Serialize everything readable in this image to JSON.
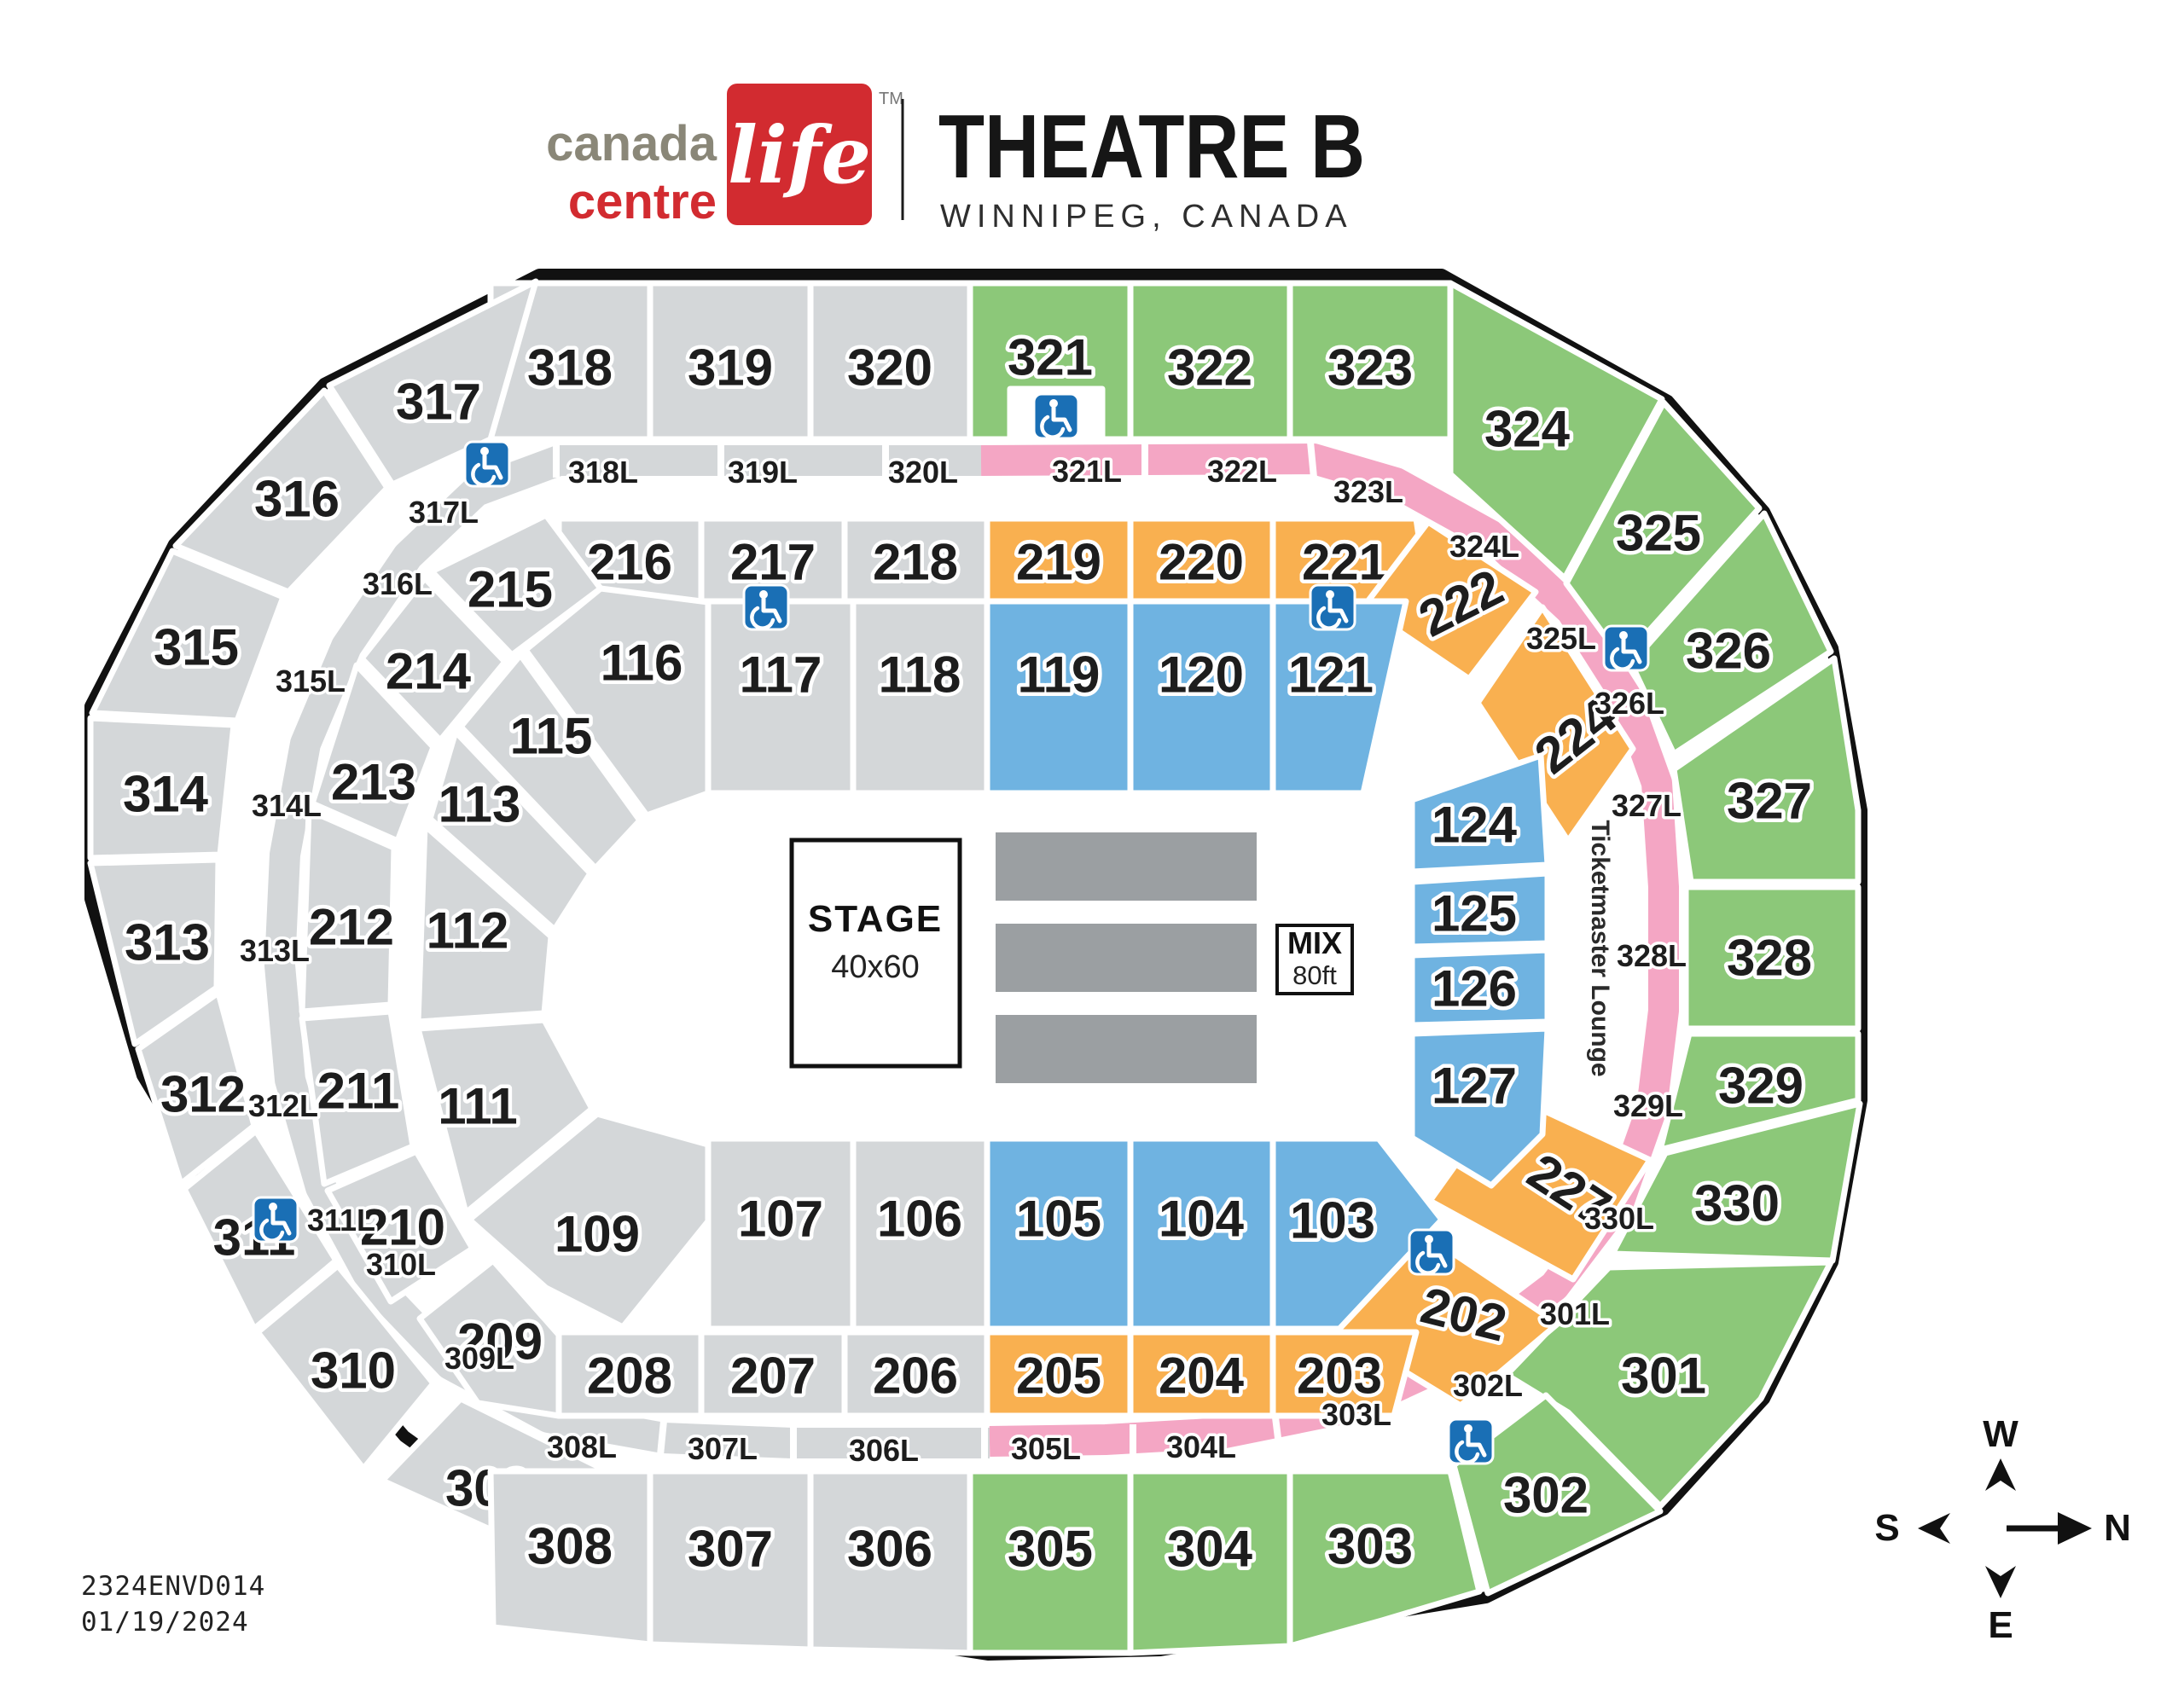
{
  "header": {
    "brand": {
      "word1": "canada",
      "word2": "life",
      "word3": "centre",
      "tm": "TM"
    },
    "title": "THEATRE B",
    "subtitle": "WINNIPEG, CANADA"
  },
  "footer": {
    "code": "2324ENVD014",
    "date": "01/19/2024"
  },
  "compass": {
    "up": "W",
    "right": "N",
    "left": "S",
    "down": "E"
  },
  "stage": {
    "line1": "STAGE",
    "line2": "40x60"
  },
  "mix": {
    "line1": "MIX",
    "line2": "80ft"
  },
  "lounge": {
    "label": "Ticketmaster Lounge"
  },
  "accessibility": {
    "icon": "wheelchair-icon",
    "count": 8
  },
  "colors": {
    "green": "#8CC879",
    "orange": "#F9B050",
    "blue": "#6FB3E1",
    "pink": "#F4A6C4",
    "gray": "#D4D7D9",
    "floor_block": "#9B9FA2",
    "outline": "#111111",
    "wheelchair": "#1A6FB5",
    "brand_red": "#D22B30",
    "brand_gray": "#8A8778"
  },
  "sections": [
    {
      "id": "318",
      "label": "318",
      "color": "gray"
    },
    {
      "id": "319",
      "label": "319",
      "color": "gray"
    },
    {
      "id": "320",
      "label": "320",
      "color": "gray"
    },
    {
      "id": "321",
      "label": "321",
      "color": "green"
    },
    {
      "id": "322",
      "label": "322",
      "color": "green"
    },
    {
      "id": "323",
      "label": "323",
      "color": "green"
    },
    {
      "id": "317",
      "label": "317",
      "color": "gray"
    },
    {
      "id": "324",
      "label": "324",
      "color": "green"
    },
    {
      "id": "316",
      "label": "316",
      "color": "gray"
    },
    {
      "id": "325",
      "label": "325",
      "color": "green"
    },
    {
      "id": "315",
      "label": "315",
      "color": "gray"
    },
    {
      "id": "326",
      "label": "326",
      "color": "green"
    },
    {
      "id": "314",
      "label": "314",
      "color": "gray"
    },
    {
      "id": "327",
      "label": "327",
      "color": "green"
    },
    {
      "id": "313",
      "label": "313",
      "color": "gray"
    },
    {
      "id": "328",
      "label": "328",
      "color": "green"
    },
    {
      "id": "312",
      "label": "312",
      "color": "gray"
    },
    {
      "id": "329",
      "label": "329",
      "color": "green"
    },
    {
      "id": "311",
      "label": "311",
      "color": "gray"
    },
    {
      "id": "330",
      "label": "330",
      "color": "green"
    },
    {
      "id": "310",
      "label": "310",
      "color": "gray"
    },
    {
      "id": "301",
      "label": "301",
      "color": "green"
    },
    {
      "id": "309",
      "label": "309",
      "color": "gray"
    },
    {
      "id": "302",
      "label": "302",
      "color": "green"
    },
    {
      "id": "308",
      "label": "308",
      "color": "gray"
    },
    {
      "id": "307",
      "label": "307",
      "color": "gray"
    },
    {
      "id": "306",
      "label": "306",
      "color": "gray"
    },
    {
      "id": "305",
      "label": "305",
      "color": "green"
    },
    {
      "id": "304",
      "label": "304",
      "color": "green"
    },
    {
      "id": "303",
      "label": "303",
      "color": "green"
    },
    {
      "id": "216",
      "label": "216",
      "color": "gray"
    },
    {
      "id": "217",
      "label": "217",
      "color": "gray"
    },
    {
      "id": "218",
      "label": "218",
      "color": "gray"
    },
    {
      "id": "219",
      "label": "219",
      "color": "orange"
    },
    {
      "id": "220",
      "label": "220",
      "color": "orange"
    },
    {
      "id": "221",
      "label": "221",
      "color": "orange"
    },
    {
      "id": "215",
      "label": "215",
      "color": "gray"
    },
    {
      "id": "222",
      "label": "222",
      "color": "orange"
    },
    {
      "id": "214",
      "label": "214",
      "color": "gray"
    },
    {
      "id": "224",
      "label": "224",
      "color": "orange"
    },
    {
      "id": "213",
      "label": "213",
      "color": "gray"
    },
    {
      "id": "212",
      "label": "212",
      "color": "gray"
    },
    {
      "id": "211",
      "label": "211",
      "color": "gray"
    },
    {
      "id": "210",
      "label": "210",
      "color": "gray"
    },
    {
      "id": "209",
      "label": "209",
      "color": "gray"
    },
    {
      "id": "227",
      "label": "227",
      "color": "orange"
    },
    {
      "id": "202",
      "label": "202",
      "color": "orange"
    },
    {
      "id": "208",
      "label": "208",
      "color": "gray"
    },
    {
      "id": "207",
      "label": "207",
      "color": "gray"
    },
    {
      "id": "206",
      "label": "206",
      "color": "gray"
    },
    {
      "id": "205",
      "label": "205",
      "color": "orange"
    },
    {
      "id": "204",
      "label": "204",
      "color": "orange"
    },
    {
      "id": "203",
      "label": "203",
      "color": "orange"
    },
    {
      "id": "116",
      "label": "116",
      "color": "gray"
    },
    {
      "id": "117",
      "label": "117",
      "color": "gray"
    },
    {
      "id": "118",
      "label": "118",
      "color": "gray"
    },
    {
      "id": "119",
      "label": "119",
      "color": "blue"
    },
    {
      "id": "120",
      "label": "120",
      "color": "blue"
    },
    {
      "id": "121",
      "label": "121",
      "color": "blue"
    },
    {
      "id": "115",
      "label": "115",
      "color": "gray"
    },
    {
      "id": "113",
      "label": "113",
      "color": "gray"
    },
    {
      "id": "124",
      "label": "124",
      "color": "blue"
    },
    {
      "id": "125",
      "label": "125",
      "color": "blue"
    },
    {
      "id": "126",
      "label": "126",
      "color": "blue"
    },
    {
      "id": "127",
      "label": "127",
      "color": "blue"
    },
    {
      "id": "112",
      "label": "112",
      "color": "gray"
    },
    {
      "id": "111",
      "label": "111",
      "color": "gray"
    },
    {
      "id": "109",
      "label": "109",
      "color": "gray"
    },
    {
      "id": "107",
      "label": "107",
      "color": "gray"
    },
    {
      "id": "106",
      "label": "106",
      "color": "gray"
    },
    {
      "id": "105",
      "label": "105",
      "color": "blue"
    },
    {
      "id": "104",
      "label": "104",
      "color": "blue"
    },
    {
      "id": "103",
      "label": "103",
      "color": "blue"
    }
  ],
  "band_labels": [
    {
      "id": "318L",
      "label": "318L",
      "color": "gray"
    },
    {
      "id": "319L",
      "label": "319L",
      "color": "gray"
    },
    {
      "id": "320L",
      "label": "320L",
      "color": "gray"
    },
    {
      "id": "321L",
      "label": "321L",
      "color": "pink"
    },
    {
      "id": "322L",
      "label": "322L",
      "color": "pink"
    },
    {
      "id": "323L",
      "label": "323L",
      "color": "pink"
    },
    {
      "id": "324L",
      "label": "324L",
      "color": "pink"
    },
    {
      "id": "325L",
      "label": "325L",
      "color": "pink"
    },
    {
      "id": "326L",
      "label": "326L",
      "color": "pink"
    },
    {
      "id": "327L",
      "label": "327L",
      "color": "pink"
    },
    {
      "id": "328L",
      "label": "328L",
      "color": "pink"
    },
    {
      "id": "329L",
      "label": "329L",
      "color": "pink"
    },
    {
      "id": "330L",
      "label": "330L",
      "color": "pink"
    },
    {
      "id": "301L",
      "label": "301L",
      "color": "pink"
    },
    {
      "id": "302L",
      "label": "302L",
      "color": "pink"
    },
    {
      "id": "303L",
      "label": "303L",
      "color": "pink"
    },
    {
      "id": "304L",
      "label": "304L",
      "color": "pink"
    },
    {
      "id": "305L",
      "label": "305L",
      "color": "pink"
    },
    {
      "id": "306L",
      "label": "306L",
      "color": "gray"
    },
    {
      "id": "307L",
      "label": "307L",
      "color": "gray"
    },
    {
      "id": "308L",
      "label": "308L",
      "color": "gray"
    },
    {
      "id": "309L",
      "label": "309L",
      "color": "gray"
    },
    {
      "id": "310L",
      "label": "310L",
      "color": "gray"
    },
    {
      "id": "311L",
      "label": "311L",
      "color": "gray"
    },
    {
      "id": "312L",
      "label": "312L",
      "color": "gray"
    },
    {
      "id": "313L",
      "label": "313L",
      "color": "gray"
    },
    {
      "id": "314L",
      "label": "314L",
      "color": "gray"
    },
    {
      "id": "315L",
      "label": "315L",
      "color": "gray"
    },
    {
      "id": "316L",
      "label": "316L",
      "color": "gray"
    },
    {
      "id": "317L",
      "label": "317L",
      "color": "gray"
    }
  ]
}
